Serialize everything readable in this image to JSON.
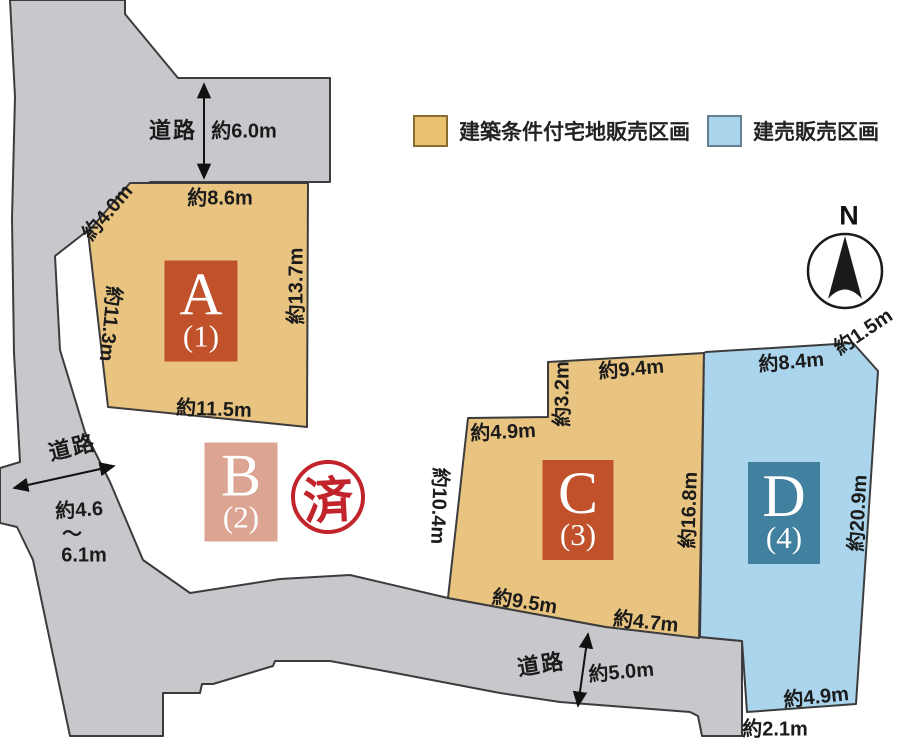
{
  "legend": {
    "items": [
      {
        "label": "建築条件付宅地販売区画",
        "color": "#ebc26f"
      },
      {
        "label": "建売販売区画",
        "color": "#a9d4ec"
      }
    ]
  },
  "compass": {
    "north_label": "N"
  },
  "roads": {
    "top": {
      "label": "道路",
      "width": "約6.0m"
    },
    "left": {
      "label": "道路",
      "width_line1": "約4.6",
      "width_line2": "〜",
      "width_line3": "6.1m"
    },
    "bottom": {
      "label": "道路",
      "width": "約5.0m"
    }
  },
  "lots": {
    "a": {
      "letter": "A",
      "number": "(1)",
      "dims": {
        "top": "約8.6m",
        "top_left": "約4.0m",
        "left": "約11.3m",
        "right": "約13.7m",
        "bottom": "約11.5m"
      }
    },
    "b": {
      "letter": "B",
      "number": "(2)",
      "status_stamp": "済"
    },
    "c": {
      "letter": "C",
      "number": "(3)",
      "dims": {
        "step_top": "約4.9m",
        "step_side": "約3.2m",
        "top": "約9.4m",
        "left": "約10.4m",
        "right": "約16.8m",
        "bottom_left": "約9.5m",
        "bottom_right": "約4.7m"
      }
    },
    "d": {
      "letter": "D",
      "number": "(4)",
      "dims": {
        "top": "約8.4m",
        "top_right": "約1.5m",
        "right": "約20.9m",
        "bottom_right": "約4.9m",
        "bottom": "約2.1m"
      }
    }
  },
  "colors": {
    "road_gray": "#c8c8cc",
    "lot_tan": "#e9c480",
    "lot_blue": "#abd5ec",
    "label_box_orange": "#c0512b",
    "label_box_pink": "#dca492",
    "label_box_teal": "#41809f",
    "stamp_red": "#c2242c",
    "outline": "#3c3c3c"
  }
}
